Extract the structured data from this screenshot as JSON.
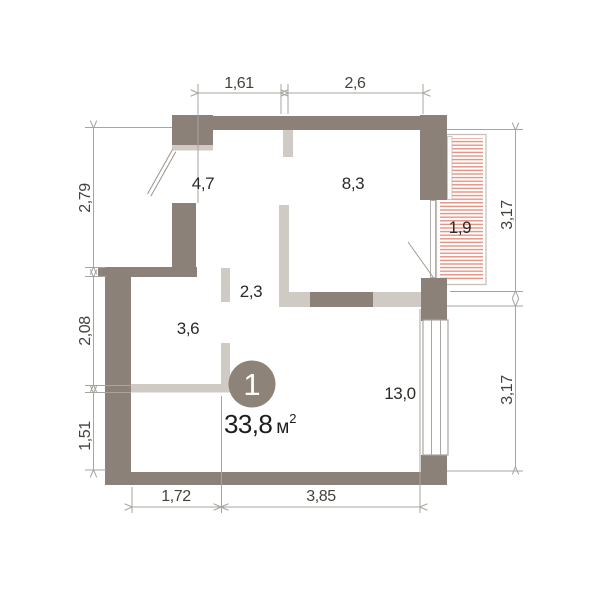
{
  "plan": {
    "unit_badge": {
      "number": "1",
      "area_value": "33,8",
      "area_unit": "м",
      "area_sup": "2"
    },
    "rooms": {
      "hall": {
        "label": "4,7"
      },
      "bedroom": {
        "label": "8,3"
      },
      "balcony": {
        "label": "1,9"
      },
      "corridor": {
        "label": "2,3"
      },
      "bathroom": {
        "label": "3,6"
      },
      "living": {
        "label": "13,0"
      }
    },
    "dims": {
      "top_left": "1,61",
      "top_right": "2,6",
      "left_top": "2,79",
      "left_mid": "2,08",
      "left_bottom": "1,51",
      "right_top": "3,17",
      "right_bottom": "3,17",
      "bottom_left": "1,72",
      "bottom_right": "3,85"
    },
    "colors": {
      "wall_dark": "#8b8178",
      "wall_light": "#cfcbc4",
      "balcony_hatch": "#e59282",
      "dim_line": "#a8a49e",
      "dim_text": "#45423d",
      "room_text": "#2c2a27",
      "badge_fill": "#8d8379",
      "badge_text": "#ffffff"
    }
  }
}
